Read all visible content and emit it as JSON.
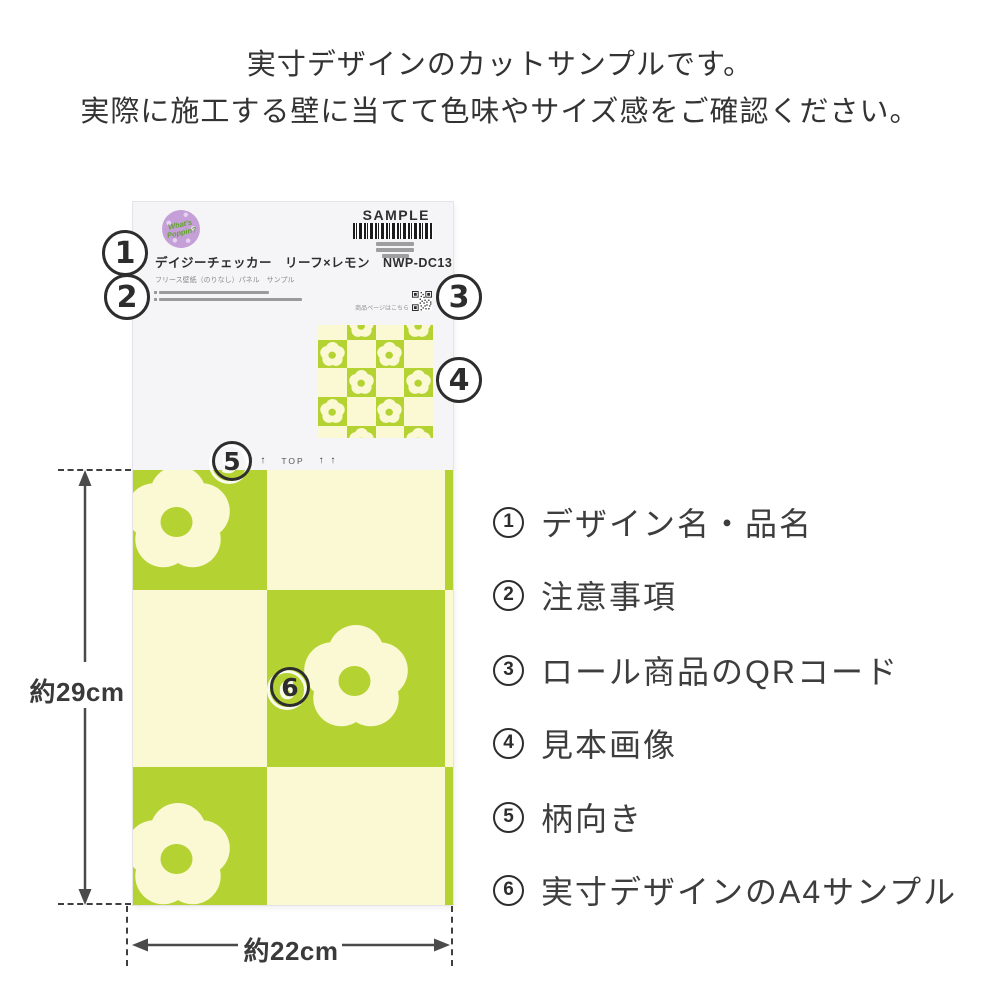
{
  "heading": {
    "line1": "実寸デザインのカットサンプルです。",
    "line2": "実際に施工する壁に当てて色味やサイズ感をご確認ください。"
  },
  "sample_card": {
    "badge": {
      "line1": "What's",
      "line2": "Poppin?"
    },
    "sample_label": "SAMPLE",
    "product_title": "デイジーチェッカー　リーフ×レモン　NWP-DC13",
    "product_subtitle": "フリース壁紙（のりなし）パネル　サンプル",
    "qr_caption": "商品ページはこちら",
    "top_marking": {
      "arrows_left": "↑ ↑",
      "label": "TOP",
      "arrows_right": "↑ ↑"
    },
    "pattern": {
      "main_grid": [
        [
          2,
          0,
          1
        ],
        [
          0,
          2,
          0
        ],
        [
          2,
          0,
          1
        ]
      ],
      "thumb_grid": [
        [
          0,
          2,
          0,
          2
        ],
        [
          2,
          0,
          2,
          0
        ],
        [
          0,
          2,
          0,
          2
        ],
        [
          2,
          0,
          2,
          0
        ],
        [
          0,
          2,
          0,
          2
        ]
      ]
    }
  },
  "dimensions": {
    "height_label": "約29cm",
    "width_label": "約22cm"
  },
  "markers": [
    "1",
    "2",
    "3",
    "4",
    "5",
    "6"
  ],
  "legend": {
    "items": [
      {
        "number": "1",
        "label": "デザイン名・品名"
      },
      {
        "number": "2",
        "label": "注意事項"
      },
      {
        "number": "3",
        "label": "ロール商品のQRコード"
      },
      {
        "number": "4",
        "label": "見本画像"
      },
      {
        "number": "5",
        "label": "柄向き"
      },
      {
        "number": "6",
        "label": "実寸デザインのA4サンプル"
      }
    ]
  },
  "colors": {
    "pattern_green": "#b5d233",
    "pattern_cream": "#faf9d4",
    "card_bg": "#f5f5f7",
    "badge_purple": "#c5a0d8",
    "badge_text_green": "#61a22d",
    "marker_stroke": "#2d2d2d",
    "text_dark": "#333333",
    "placeholder_gray": "#9b9b9b"
  }
}
